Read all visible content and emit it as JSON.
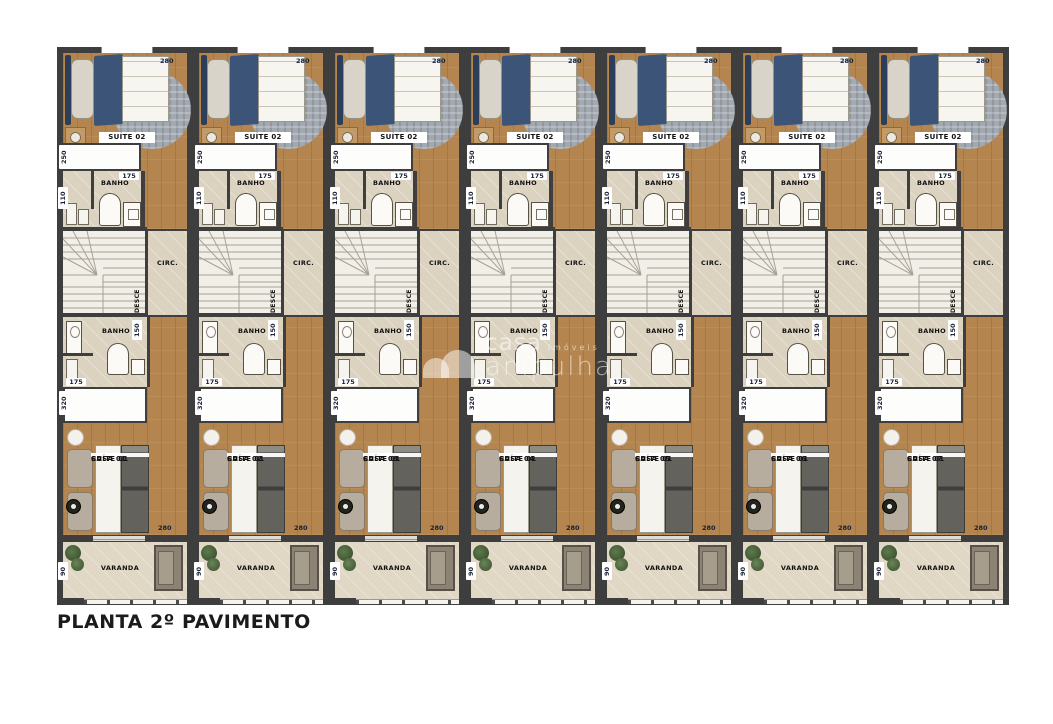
{
  "title": "PLANTA 2º PAVIMENTO",
  "watermark": {
    "brand": "casa",
    "brand_suffix": "imóveis",
    "brand_line2": "ampulha"
  },
  "unit": {
    "suite2_label": "SUÍTE 02",
    "banho_label": "BANHO",
    "circ_label": "CIRC.",
    "desce_label": "DESCE",
    "suite1_label": "SUÍTE 01",
    "varanda_label": "VARANDA",
    "dims": {
      "suite2_width": "280",
      "closet_upper": "250",
      "banho1_width": "175",
      "banho1_depth": "110",
      "banho2_depth": "150",
      "banho2_width": "175",
      "closet_lower": "320",
      "suite1_width": "280",
      "varanda_depth": "90"
    }
  },
  "units": [
    {
      "casa": "CASA 01"
    },
    {
      "casa": "CASA 02"
    },
    {
      "casa": "CASA 03"
    },
    {
      "casa": "CASA 04"
    },
    {
      "casa": "CASA 05"
    },
    {
      "casa": "CASA 06"
    },
    {
      "casa": "CASA 07"
    }
  ],
  "colors": {
    "wall": "#3e3e3e",
    "wood": "#b5854f",
    "tile": "#dcd2c0",
    "stair": "#f1efe8",
    "blanket": "#3b5477",
    "rug": "#a3a9b1",
    "dim_text": "#1a2233"
  }
}
